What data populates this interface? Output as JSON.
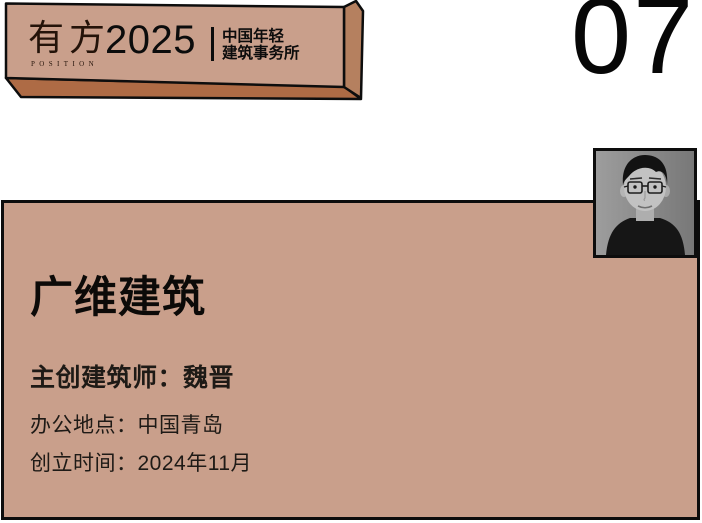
{
  "banner": {
    "logo": "有方",
    "logo_caption": "POSITION",
    "year": "2025",
    "subtitle_line1": "中国年轻",
    "subtitle_line2": "建筑事务所"
  },
  "page_number": "07",
  "card": {
    "studio_name": "广维建筑",
    "architect": "主创建筑师：魏晋",
    "location": "办公地点：中国青岛",
    "founded": "创立时间：2024年11月"
  },
  "colors": {
    "salmon": "#c99f8b",
    "banner_side_face": "#b5805f",
    "banner_bottom_face": "#ae6b45",
    "ink": "#0d0d0d",
    "photo_background": "#8a8a8a"
  }
}
